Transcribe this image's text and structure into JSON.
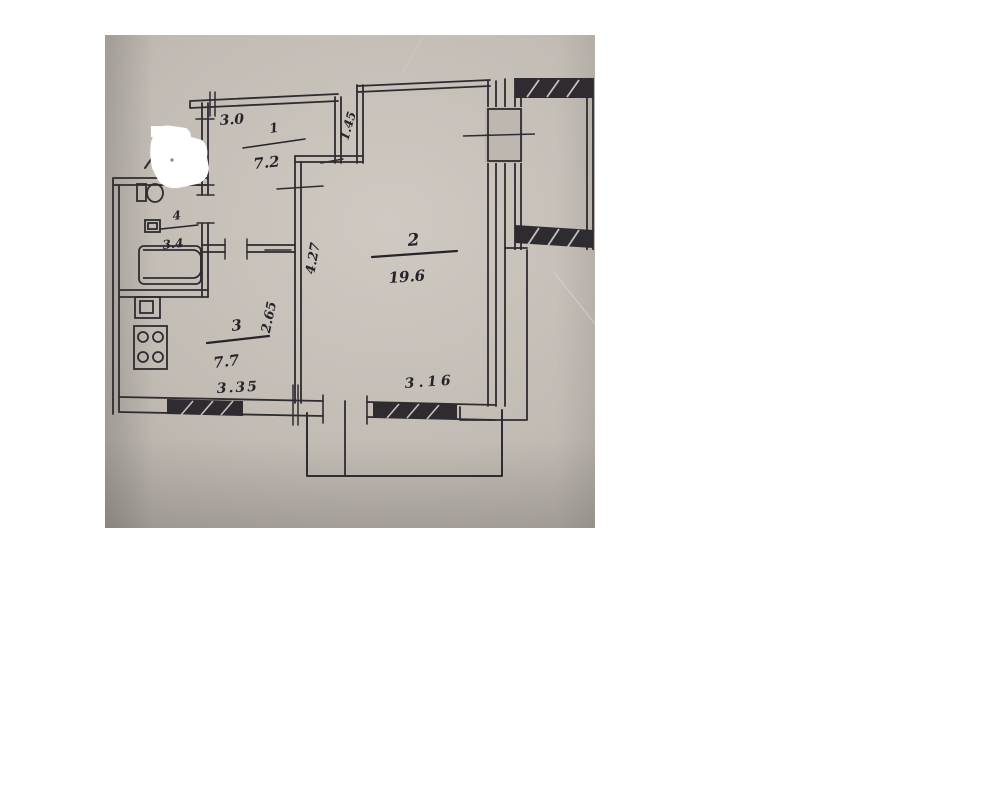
{
  "photo": {
    "kind": "scanned hand-drawn apartment floor plan",
    "rooms": {
      "r1": {
        "number": "1",
        "area": "7.2"
      },
      "r2": {
        "number": "2",
        "area": "19.6"
      },
      "r3": {
        "number": "3",
        "area": "7.7"
      },
      "r4": {
        "number": "4",
        "area": "3.4"
      }
    },
    "dimensions": {
      "top_width": "3.0",
      "niche_height": "1.45",
      "room2_depth": "4.27",
      "kitchen_depth": "2.65",
      "bottom_left_width": "3.35",
      "bottom_right_width": "3.16"
    },
    "symbols": [
      "bathtub",
      "toilet",
      "washbasin",
      "gas-stove",
      "window-hatch",
      "balcony"
    ],
    "colors": {
      "paper": "#bdb7b0",
      "ink": "#2e2c30",
      "patch": "#ffffff"
    }
  }
}
